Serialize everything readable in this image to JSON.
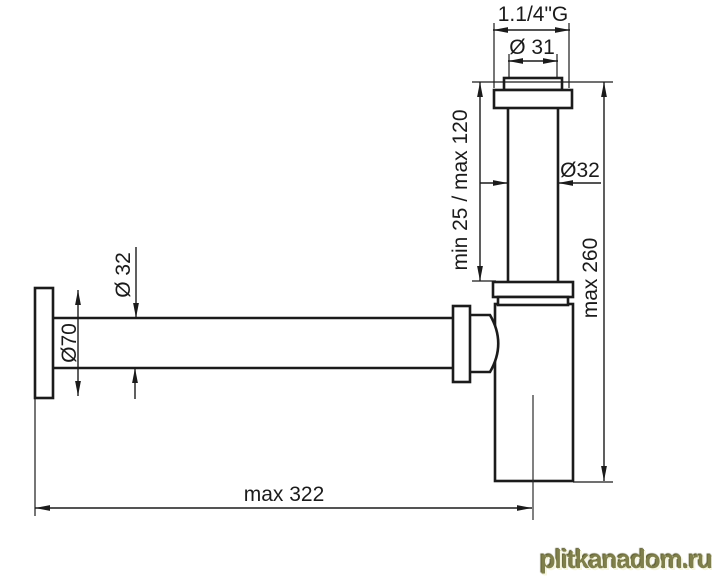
{
  "drawing": {
    "labels": {
      "thread_size": "1.1/4\"G",
      "outlet_diameter": "Ø 31",
      "tube_diameter": "Ø32",
      "height_adjustment": "min 25 / max 120",
      "total_height": "max 260",
      "flange_diameter": "Ø70",
      "inlet_diameter": "Ø 32",
      "total_length": "max 322"
    },
    "line_color": "#1b1b1b",
    "background_color": "#ffffff"
  },
  "watermark": {
    "text": "plitkanadom.ru",
    "color": "#7f7f4b"
  }
}
